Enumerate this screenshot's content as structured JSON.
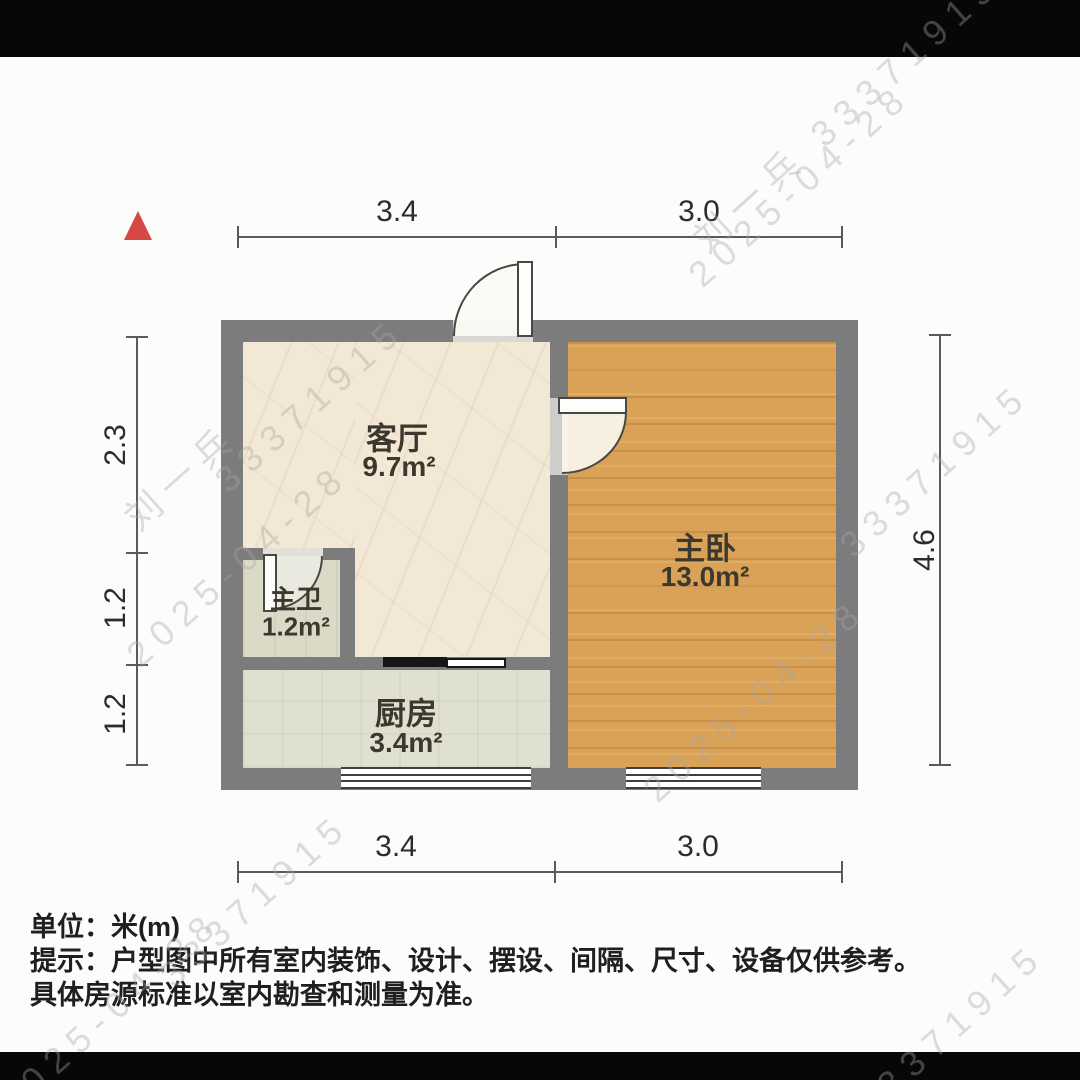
{
  "rooms": [
    {
      "name": "客厅",
      "area": "9.7m²"
    },
    {
      "name": "主卧",
      "area": "13.0m²"
    },
    {
      "name": "主卫",
      "area": "1.2m²"
    },
    {
      "name": "厨房",
      "area": "3.4m²"
    }
  ],
  "dimensions": {
    "top": [
      "3.4",
      "3.0"
    ],
    "bottom": [
      "3.4",
      "3.0"
    ],
    "left": [
      "2.3",
      "1.2",
      "1.2"
    ],
    "right": [
      "4.6"
    ]
  },
  "notes": [
    "单位：米(m)",
    "提示：户型图中所有室内装饰、设计、摆设、间隔、尺寸、设备仅供参考。",
    "具体房源标准以室内勘查和测量为准。"
  ],
  "watermarks": [
    "刘一兵 33371915",
    "2025-04-28",
    "33371915",
    "刘一兵",
    "2025-04-28",
    "33371915",
    "2025-04-28",
    "33371915",
    "2025-04-28",
    "33371915"
  ],
  "colors": {
    "north_arrow": "#d64843",
    "wall": "#7c7c7c",
    "living_floor": "#f2e8d5",
    "bedroom_floor": "#d9a257",
    "kitchen_floor": "#e0e0d0",
    "bathroom_floor": "#dbdac7"
  }
}
